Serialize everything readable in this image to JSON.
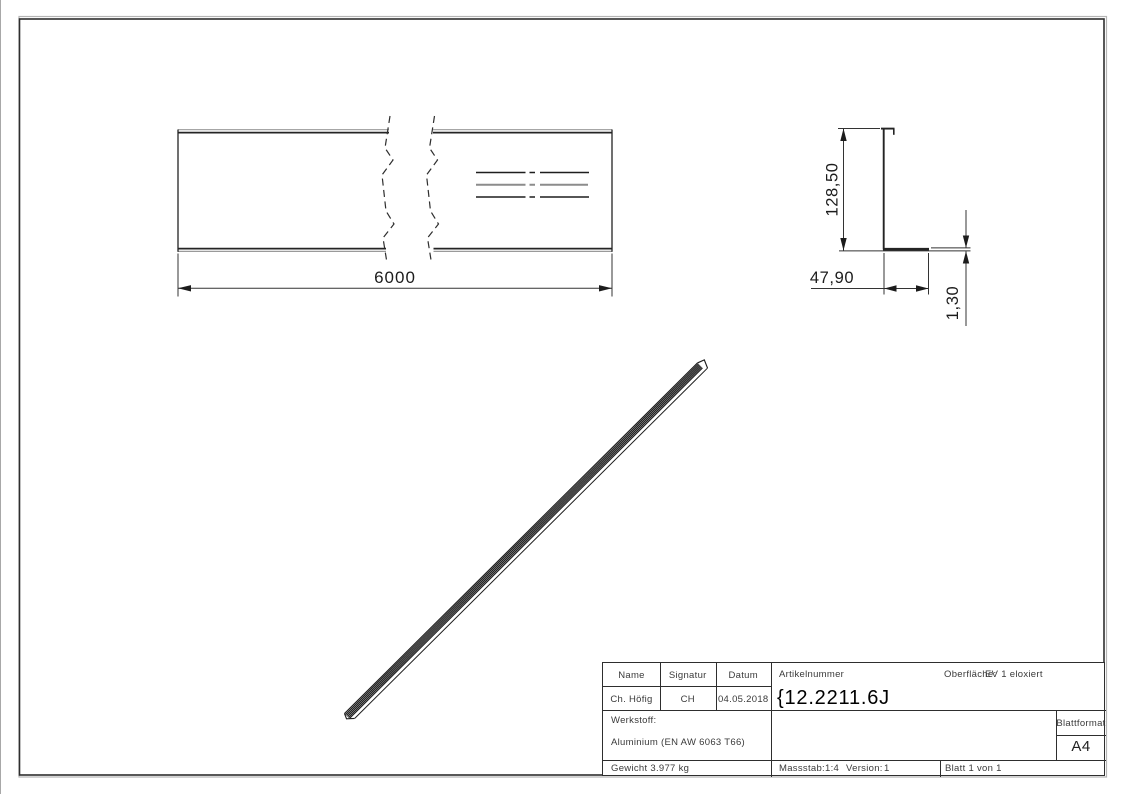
{
  "dimensions": {
    "length": "6000",
    "height": "128,50",
    "flange_width": "47,90",
    "thickness": "1,30"
  },
  "title_block": {
    "col_name": "Name",
    "col_signatur": "Signatur",
    "col_datum": "Datum",
    "name": "Ch. Höfig",
    "signatur": "CH",
    "datum": "04.05.2018",
    "artikelnummer_label": "Artikelnummer",
    "artikelnummer": "{12.2211.6J",
    "oberflaeche_label": "Oberfläche:",
    "oberflaeche": "EV 1 eloxiert",
    "werkstoff_label": "Werkstoff:",
    "werkstoff": "Aluminium (EN AW 6063 T66)",
    "gewicht": "Gewicht 3.977 kg",
    "massstab_label": "Massstab:",
    "massstab": "1:4",
    "version_label": "Version:",
    "version": "1",
    "blatt": "Blatt 1 von 1",
    "blattformat_label": "Blattformat",
    "blattformat": "A4"
  }
}
